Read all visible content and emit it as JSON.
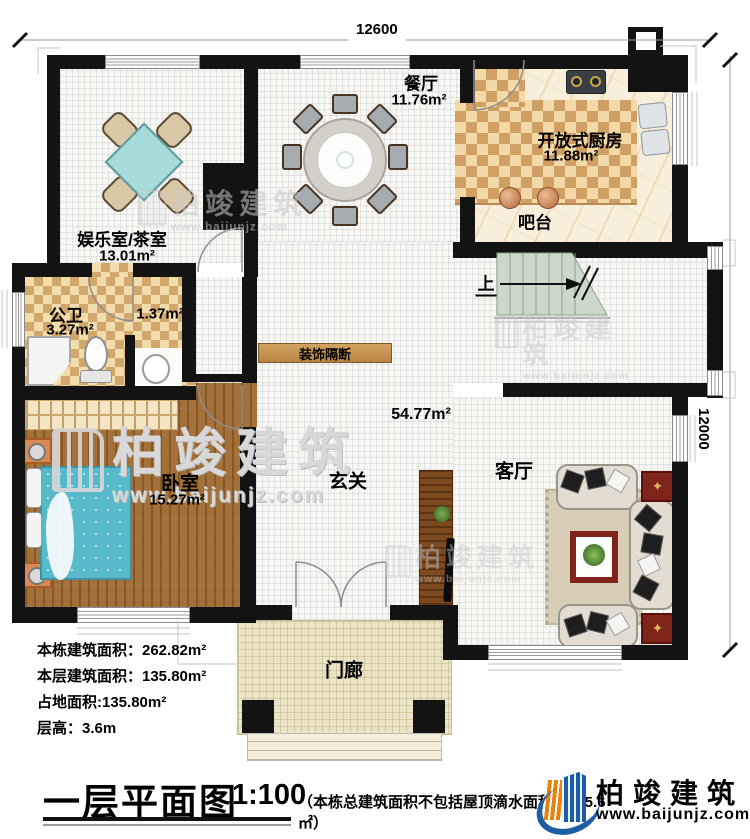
{
  "plan": {
    "title": "一层平面图",
    "scale": "1:100",
    "note": "（本栋总建筑面积不包括屋顶滴水面积：175.6㎡）",
    "dims": {
      "width_label": "12600",
      "height_label": "12000"
    },
    "info_lines": [
      "本栋建筑面积：262.82m²",
      "本层建筑面积：135.80m²",
      "占地面积:135.80m²",
      "层高：3.6m"
    ]
  },
  "rooms": [
    {
      "name": "餐厅",
      "area": "11.76m²"
    },
    {
      "name": "开放式厨房",
      "area": "11.88m²"
    },
    {
      "name": "吧台",
      "area": ""
    },
    {
      "name": "娱乐室/茶室",
      "area": "13.01m²"
    },
    {
      "name": "公卫",
      "area": "3.27m²"
    },
    {
      "name": "",
      "area": "1.37m²"
    },
    {
      "name": "卧室",
      "area": "15.27m²"
    },
    {
      "name": "玄关",
      "area": ""
    },
    {
      "name": "客厅",
      "area": ""
    },
    {
      "name": "门廊",
      "area": ""
    },
    {
      "name": "装饰隔断",
      "area": ""
    },
    {
      "name": "上",
      "area": ""
    },
    {
      "name": "",
      "area": "54.77m²"
    }
  ],
  "brand": {
    "name": "柏竣建筑",
    "url": "www.baijunjz.com"
  },
  "colors": {
    "wall": "#131313",
    "checker": "#cf9f63",
    "wood": "#a4703a",
    "stairs": "#cdd7ca",
    "bed": "#57b9c9",
    "logo_blue": "#1b5ea6",
    "logo_orange": "#e8820c"
  }
}
